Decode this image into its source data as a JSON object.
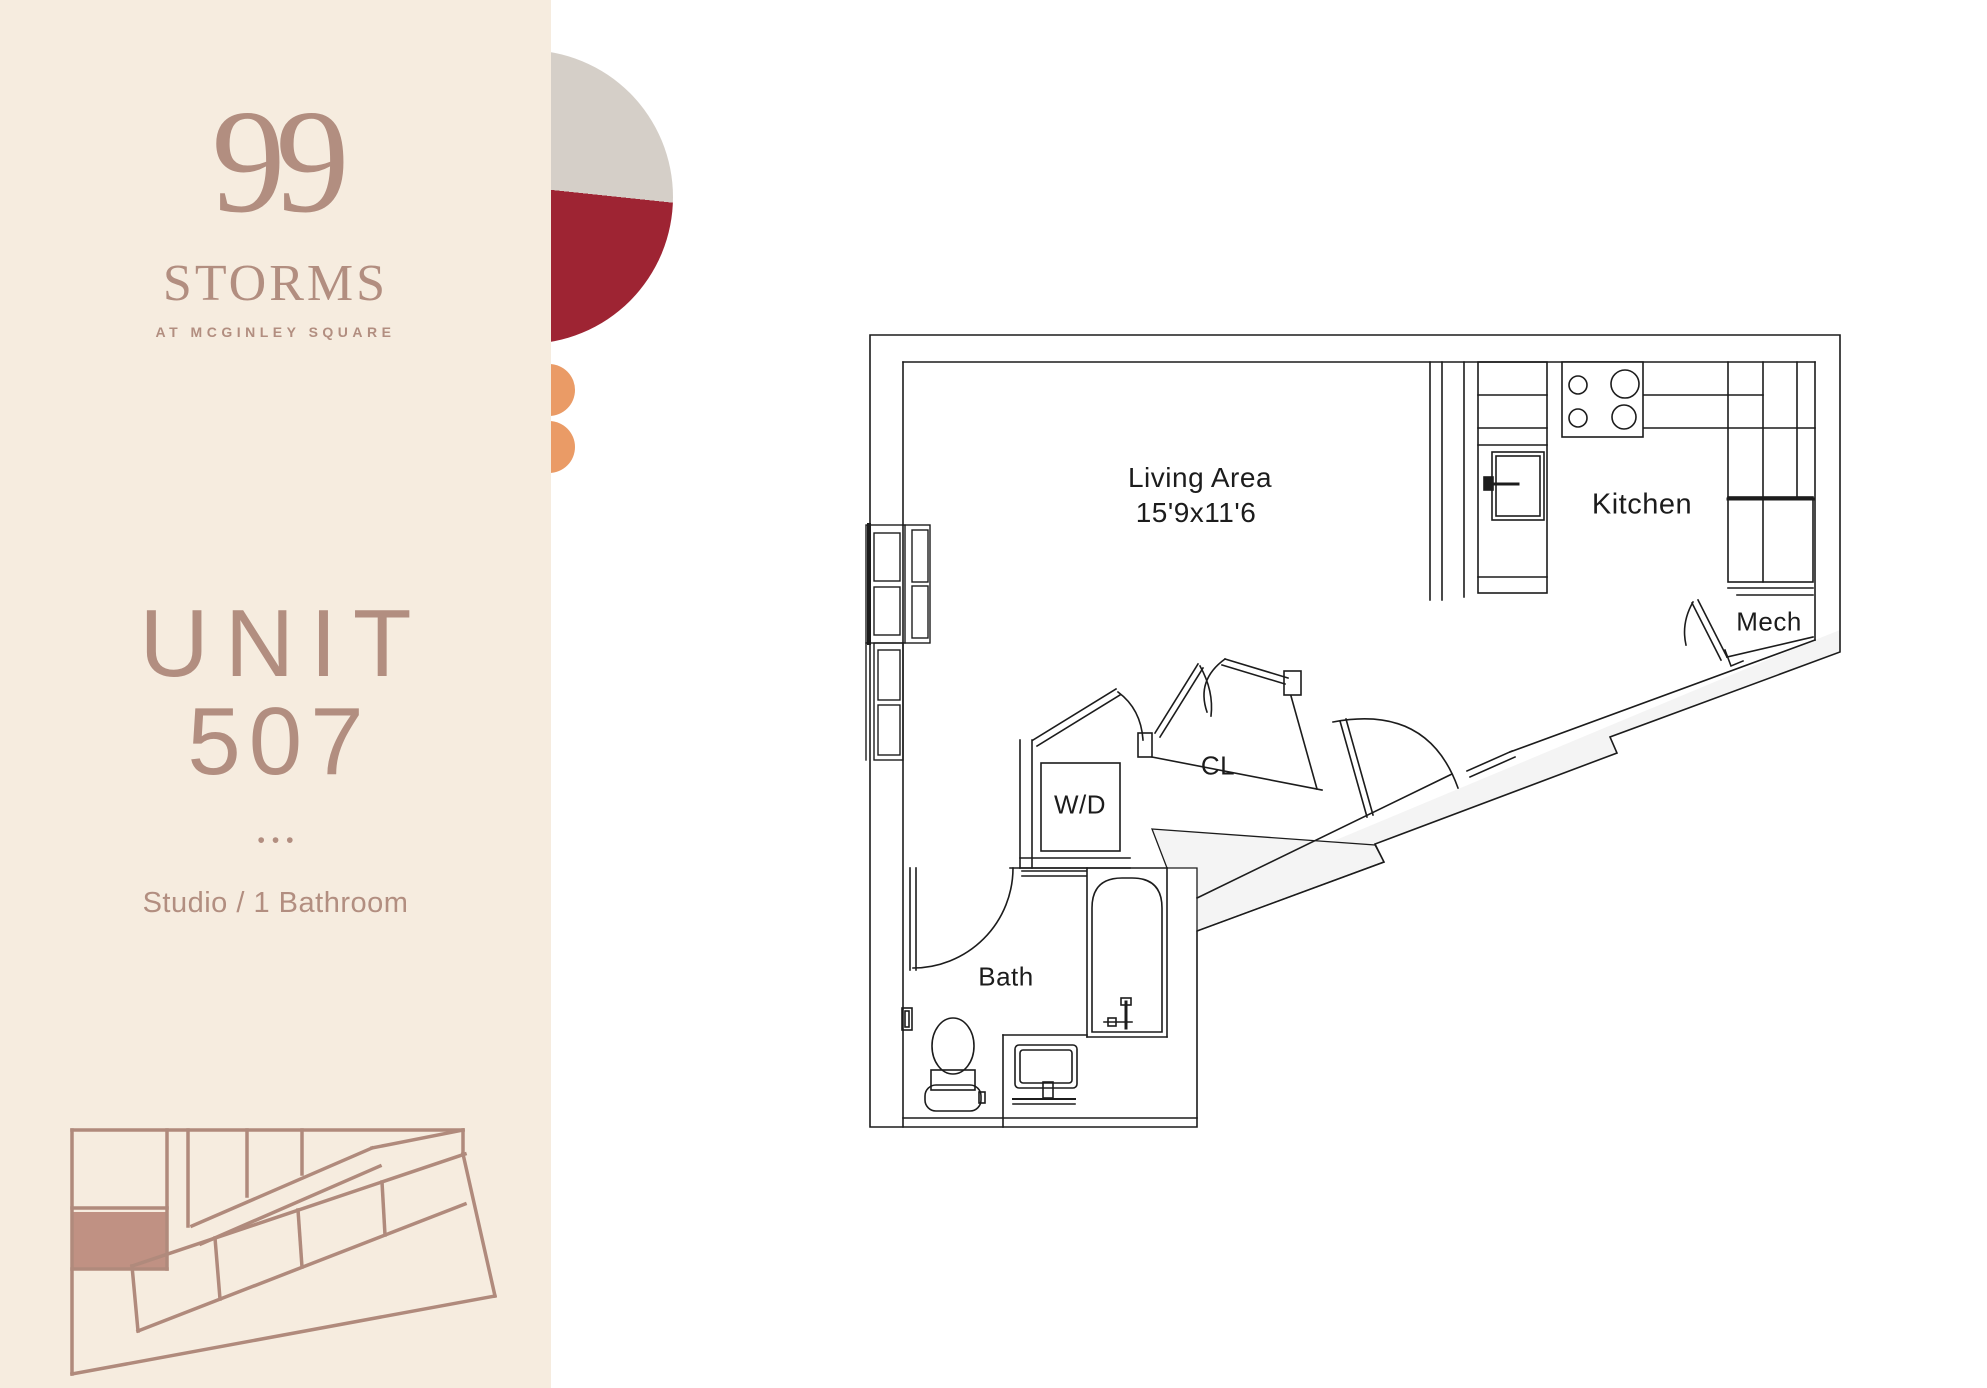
{
  "brand": {
    "number": "99",
    "name": "STORMS",
    "tagline": "AT MCGINLEY SQUARE"
  },
  "unit": {
    "label": "UNIT",
    "number": "507",
    "separator": "•••",
    "type": "Studio / 1 Bathroom"
  },
  "floor_plan": {
    "living_area": {
      "name": "Living Area",
      "dimensions": "15'9x11'6"
    },
    "kitchen": {
      "name": "Kitchen"
    },
    "mech": {
      "name": "Mech"
    },
    "closet": {
      "name": "CL"
    },
    "washer_dryer": {
      "name": "W/D"
    },
    "bath": {
      "name": "Bath"
    }
  },
  "colors": {
    "sidebar_background": "#f6ecdf",
    "brand_rose": "#b28e80",
    "keyplan_fill": "#c09183",
    "circle_gray": "#d5cfc8",
    "circle_crimson": "#9e2433",
    "dot_orange": "#ea9b66",
    "plan_line": "#1c1c1c"
  }
}
